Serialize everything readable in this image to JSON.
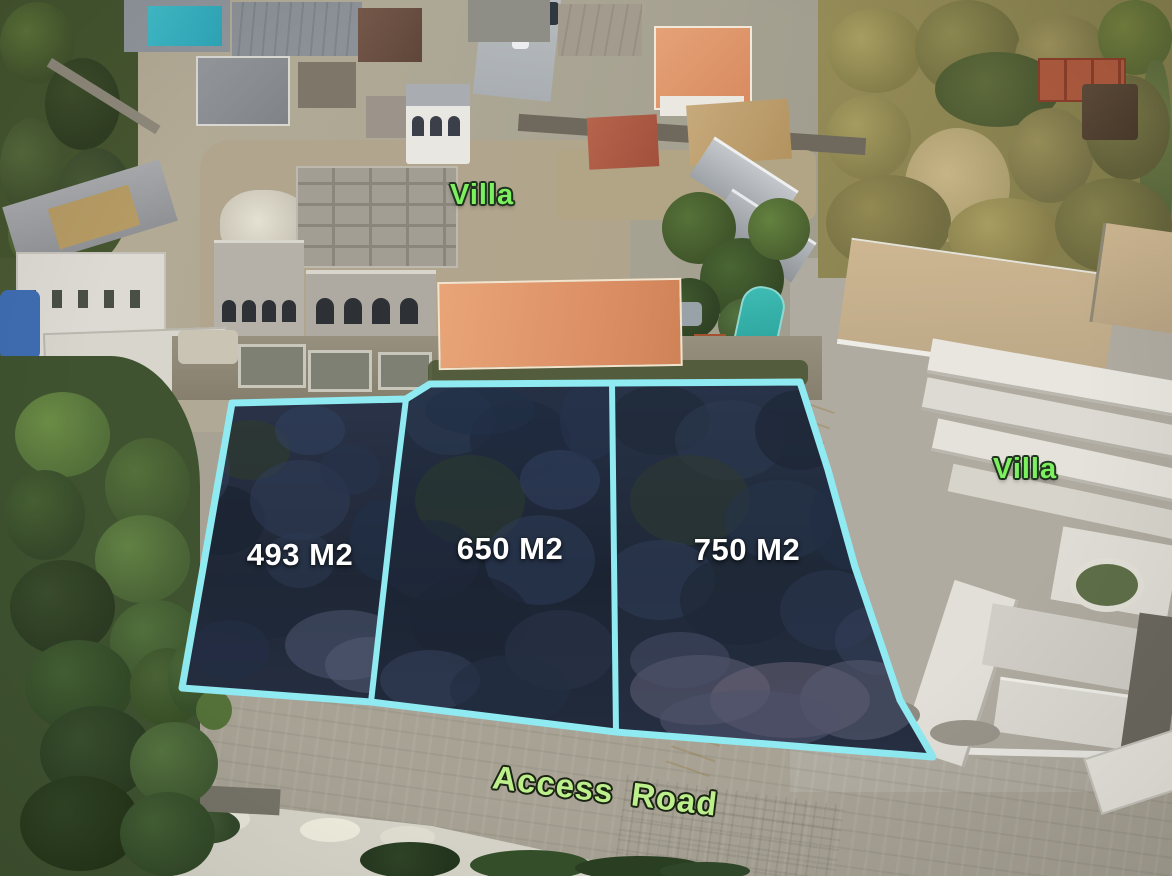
{
  "overlay": {
    "villa_label_top": "Villa",
    "villa_label_right": "Villa",
    "road_label": "Access Road",
    "plots": [
      {
        "area_label": "493 M2"
      },
      {
        "area_label": "650 M2"
      },
      {
        "area_label": "750 M2"
      }
    ],
    "colors": {
      "plot_outline": "#8feaf1",
      "villa_label": "#7df05f",
      "road_label": "#bdf08c",
      "area_label": "#ffffff"
    }
  }
}
